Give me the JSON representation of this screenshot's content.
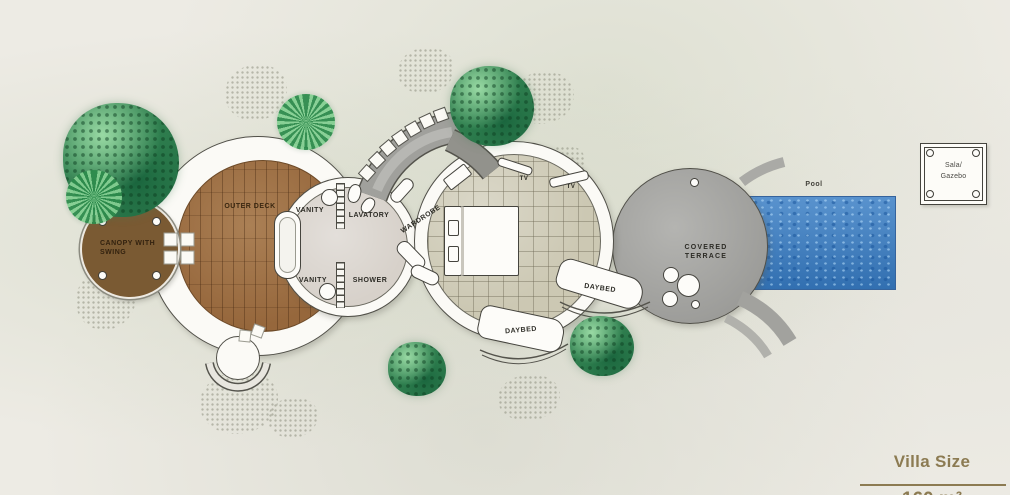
{
  "title": "Villa floor plan",
  "labels": {
    "canopy_line1": "CANOPY WITH",
    "canopy_line2": "SWING",
    "outer_deck": "OUTER DECK",
    "vanity_top": "VANITY",
    "lavatory": "LAVATORY",
    "vanity_bottom": "VANITY",
    "shower": "SHOWER",
    "wardrobe": "WARDROBE",
    "tv_left": "TV",
    "tv_right": "TV",
    "daybed_upper": "DAYBED",
    "daybed_lower": "DAYBED",
    "terrace_line1": "COVERED",
    "terrace_line2": "TERRACE",
    "pool": "Pool",
    "gazebo_line1": "Sala/",
    "gazebo_line2": "Gazebo"
  },
  "villa_size": {
    "title": "Villa Size",
    "value": "160 m²"
  },
  "colors": {
    "accent_gold": "#8c7b52",
    "pool_blue": "#3e81c6",
    "deck_wood": "#96673c",
    "canopy_brown": "#7a5a33",
    "terrace_gray": "#a8a8a5",
    "bathroom_floor": "#d7d1ca",
    "bedroom_tile": "#ccc8b3",
    "tree_green": "#3f9e63"
  }
}
